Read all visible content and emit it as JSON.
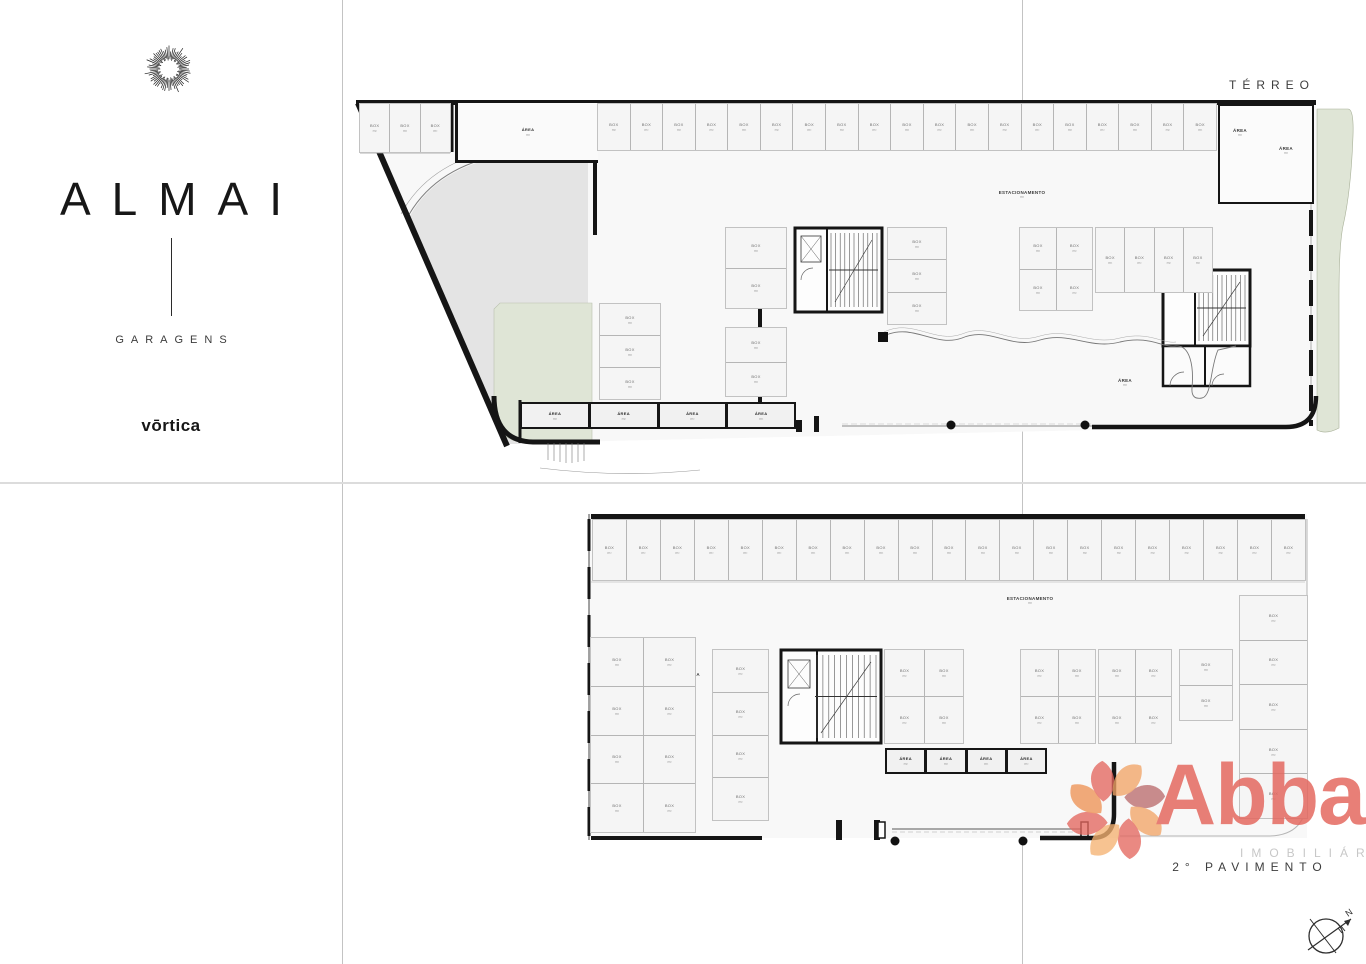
{
  "branding": {
    "icon": "sunburst",
    "title": "ALMAI",
    "subtitle": "GARAGENS",
    "developer": "vōrtica"
  },
  "plan_titles": {
    "ground": "TÉRREO",
    "second": "2° PAVIMENTO"
  },
  "labels": {
    "stall": {
      "line1": "BOX",
      "line2": "m²"
    },
    "room": {
      "line1": "ÁREA",
      "line2": "m²"
    },
    "parking": {
      "line1": "ESTACIONAMENTO",
      "line2": "m²"
    }
  },
  "terreo": {
    "top_left_stalls": 3,
    "top_row_stalls": 19,
    "cluster_b_stalls": 2,
    "cluster_c_stalls": 3,
    "cluster_d_stalls": 4,
    "cluster_e_stalls": 4,
    "cluster_f_stalls": 3,
    "cluster_g_stalls": 2,
    "bottom_rooms": 4
  },
  "pavimento2": {
    "top_row_stalls": 21,
    "left_grid_stalls": 8,
    "mid_left_stalls": 4,
    "mid_grid_stalls": 4,
    "right_grid_a_stalls": 4,
    "right_grid_b_stalls": 4,
    "right_pair_stalls": 2,
    "right_stack_stalls": 5,
    "bottom_rooms": 4
  },
  "watermark": {
    "brand": "Abba",
    "tagline": "IMOBILIÁRIA",
    "color_red": "#e4675e",
    "color_orange": "#ef9355",
    "color_peach": "#f2a466",
    "color_mauve": "#bb6b6c",
    "color_light_peach": "#f5b271"
  },
  "compass": {
    "letter": "N"
  },
  "colors": {
    "wall": "#151515",
    "stall_fill": "#f5f5f5",
    "plan_fill": "#f8f8f8",
    "green": "#dfe5d6",
    "driveway": "#e4e4e4",
    "guide": "#c3c3c3"
  }
}
